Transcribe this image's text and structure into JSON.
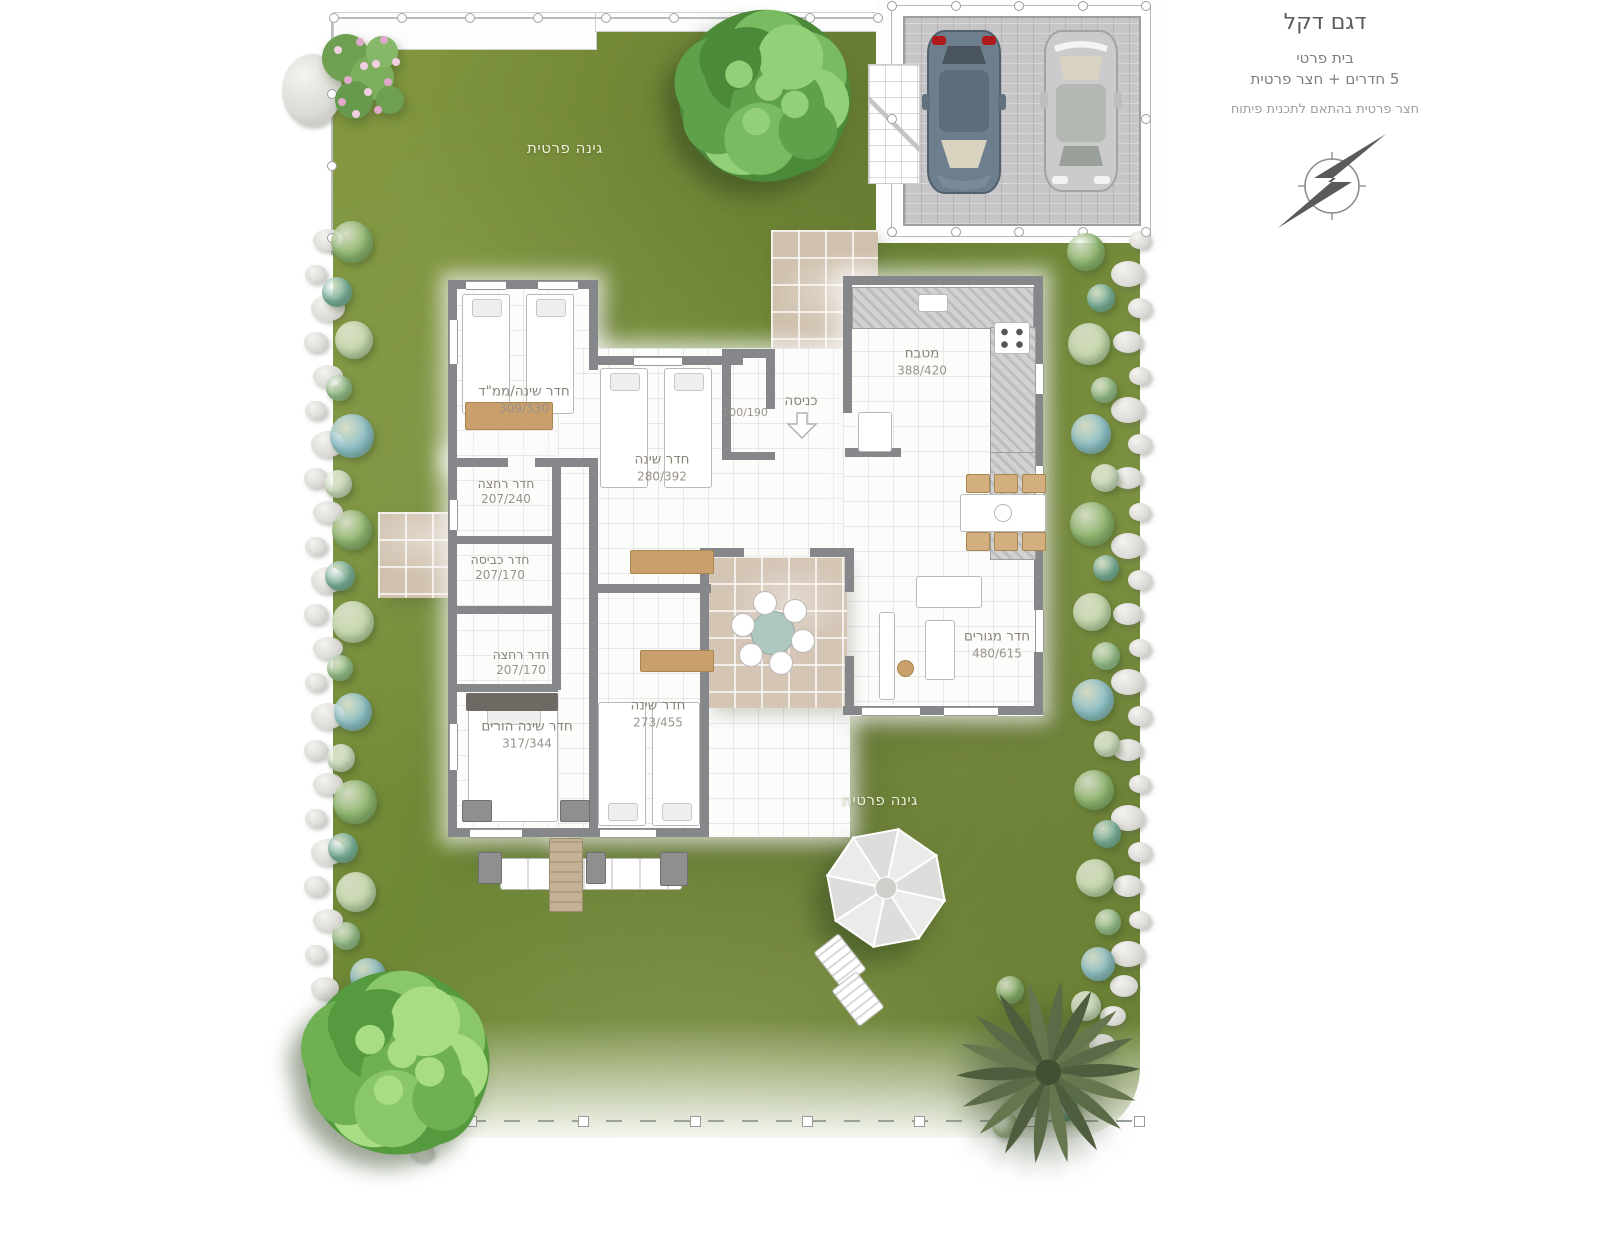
{
  "title": {
    "model": "דגם דקל",
    "type_line": "בית פרטי",
    "rooms_line": "5 חדרים + חצר פרטית",
    "note": "חצר פרטית בהתאם לתכנית פיתוח"
  },
  "garden": {
    "top_label": "גינה פרטית",
    "bottom_label": "גינה פרטית"
  },
  "entrance": {
    "label": "כניסה",
    "arrow_direction": "down"
  },
  "rooms": [
    {
      "id": "mamad",
      "name": "חדר שינה/ממ\"ד",
      "dims": "309/330"
    },
    {
      "id": "bedroom-2",
      "name": "חדר שינה",
      "dims": "280/392"
    },
    {
      "id": "bath-guest",
      "name": "",
      "dims": "100/190"
    },
    {
      "id": "bath-1",
      "name": "חדר רחצה",
      "dims": "207/240"
    },
    {
      "id": "laundry",
      "name": "חדר כביסה",
      "dims": "207/170"
    },
    {
      "id": "bath-2",
      "name": "חדר רחצה",
      "dims": "207/170"
    },
    {
      "id": "parents",
      "name": "חדר שינה הורים",
      "dims": "317/344"
    },
    {
      "id": "bedroom-3",
      "name": "חדר שינה",
      "dims": "273/455"
    },
    {
      "id": "kitchen",
      "name": "מטבח",
      "dims": "388/420"
    },
    {
      "id": "living",
      "name": "חדר מגורים",
      "dims": "480/615"
    }
  ],
  "icons": {
    "compass": "north-compass-icon",
    "entry_arrow": "entry-arrow-down-icon"
  },
  "colors": {
    "grass": "#74893a",
    "walls": "#85878a",
    "path_tile": "#d0c1ae",
    "wood_accent": "#c9a06c",
    "car_dark": "#6d7e8c",
    "car_silver": "#cbcbcb",
    "rock": "#dbdad6"
  }
}
